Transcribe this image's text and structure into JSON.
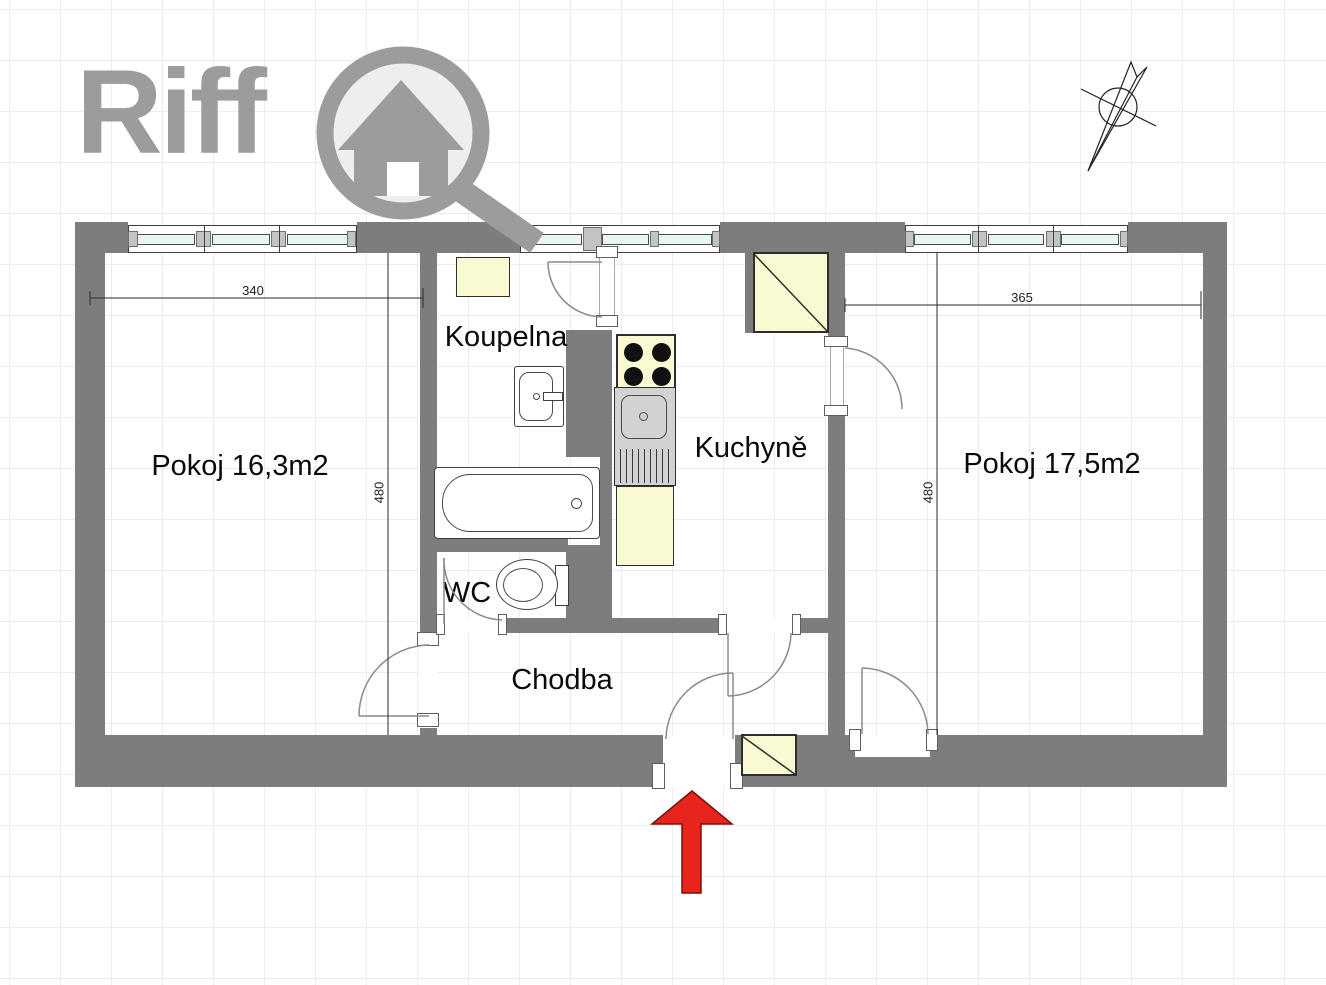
{
  "brand": {
    "name": "Riff",
    "logo_icon": "house-in-magnifier"
  },
  "rooms": {
    "left": {
      "label": "Pokoj 16,3m2"
    },
    "bathroom": {
      "label": "Koupelna"
    },
    "kitchen": {
      "label": "Kuchyně"
    },
    "wc": {
      "label": "WC"
    },
    "hallway": {
      "label": "Chodba"
    },
    "right": {
      "label": "Pokoj 17,5m2"
    }
  },
  "dimensions": {
    "left_room_width": "340",
    "left_room_height": "480",
    "right_room_width": "365",
    "right_room_height": "480"
  },
  "icons": {
    "north_indicator": "compass-north-arrow",
    "entrance_marker": "red-up-arrow"
  },
  "colors": {
    "wall_gray": "#7d7d7d",
    "cabinet_yellow": "#fafad2",
    "window_glass": "#e6f7f6",
    "entrance_arrow_red": "#e8251d",
    "logo_gray": "#9c9c9c"
  }
}
